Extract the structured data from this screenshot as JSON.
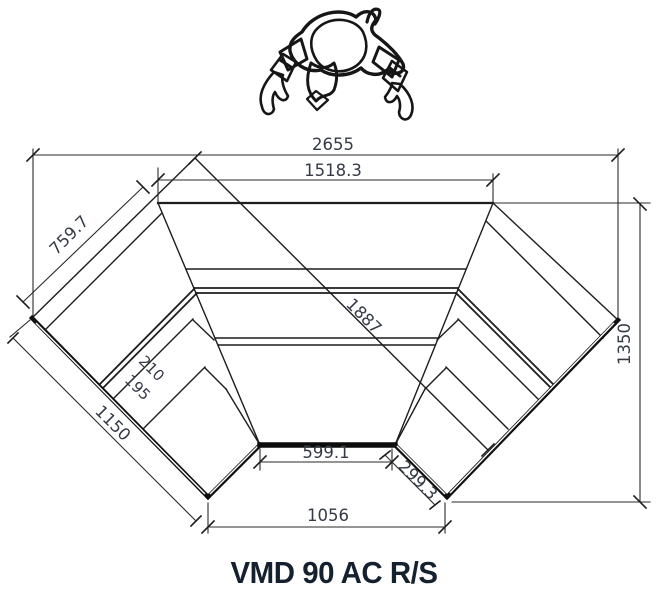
{
  "page": {
    "background": "#ffffff"
  },
  "logo": {
    "name": "crab-mascot",
    "colors": {
      "body": "#8f3a52",
      "shell": "#fdfcf6",
      "outline": "#161616",
      "band": "#f2e32d",
      "claw": "#f08b4f",
      "gem": "#1ba77d"
    }
  },
  "drawing": {
    "type": "technical-plan",
    "units": "mm",
    "line_color": "#1d1d1d",
    "dim_text_color": "#343b46",
    "dimensions": {
      "overall_width": "2655",
      "back_straight": "1518.3",
      "left_back_length": "759.7",
      "diagonal_length": "1887",
      "right_depth": "1350",
      "tier_a": "210",
      "tier_b": "195",
      "left_front_length": "1150",
      "center_front": "599.1",
      "right_chamfer": "299.3",
      "front_span": "1056"
    }
  },
  "title": {
    "text": "VMD 90 AC R/S",
    "color": "#15212e"
  }
}
